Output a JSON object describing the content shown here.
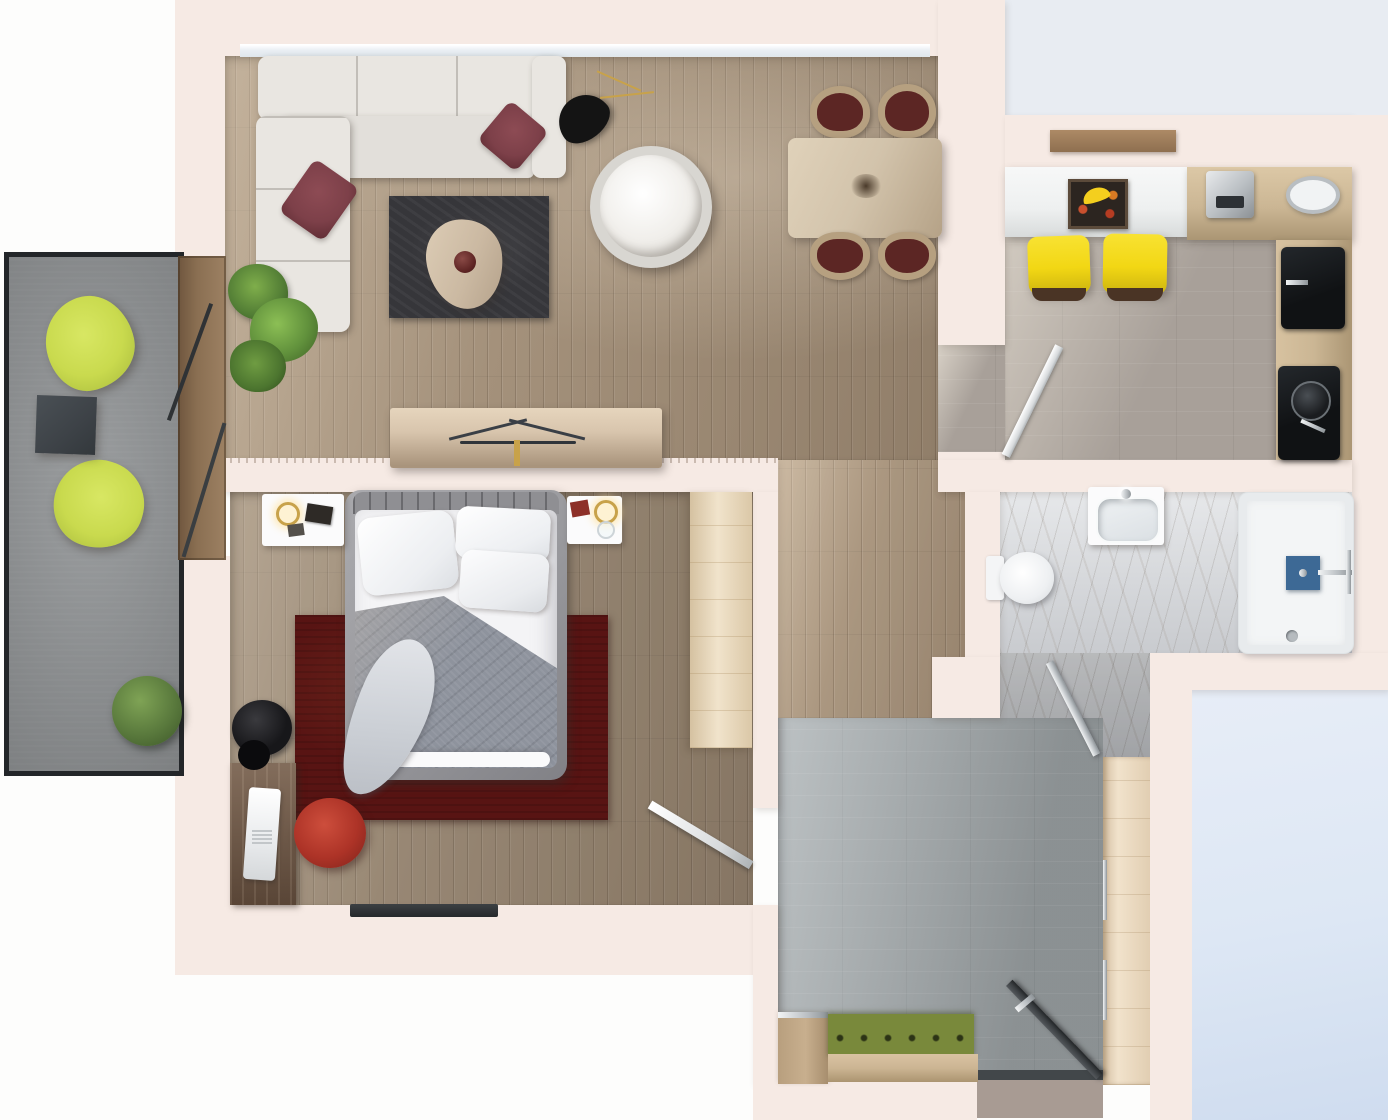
{
  "meta": {
    "title": "Top-down 3D render of a one-bedroom apartment floor plan",
    "type": "architectural-3d-floor-plan",
    "view": "top-down",
    "visible_text": "none"
  },
  "colors": {
    "pageBg": "#fdfdfc",
    "sky": "#e8ecf2",
    "outsideBlue": "#dde7f4",
    "wall": "#f6eae4",
    "woodFloor": "#9f8c76",
    "kitchenTile": "#a8a099",
    "hallTile": "#9aa0a2",
    "marble": "#d2d5d9",
    "balconyFloor": "#8d9092",
    "balconyBorder": "#232629",
    "sofa": "#e9e6e1",
    "pillowRed": "#7d4049",
    "rugLiving": "#36363a",
    "coffeeTableWood": "#cbb9a2",
    "poufWhite": "#f0eeea",
    "lampBlack": "#141414",
    "plantGreen": "#527d35",
    "sideboardWood": "#d8c5ad",
    "diningTableWood": "#d2c3ab",
    "chairSeat": "#5c2624",
    "barCounter": "#eef0f0",
    "counterWood": "#cbb694",
    "stoolYellow": "#f2d714",
    "cooktopBlack": "#101214",
    "applianceSilver": "#b9bec2",
    "bedFrame": "#9a9a9e",
    "duvetGray": "#8e939d",
    "linenWhite": "#f4f4f6",
    "rugBedroom": "#581413",
    "wardrobeWood": "#ecdaba",
    "deskWood": "#6d5645",
    "chairRed": "#ad3327",
    "showerWhite": "#f3f5f6",
    "showerBlue": "#3d6995",
    "benchGreen": "#79893b",
    "benchWood": "#ccb593",
    "closetWood": "#eedcc0",
    "doorDark": "#3c4043",
    "matTaupe": "#a89b93",
    "slidingFrame": "#8a6f52",
    "limeChair": "#c9da4e"
  },
  "scene": {
    "rooms": [
      {
        "id": "living-dining",
        "label": "Living and dining room",
        "floor": "oak plank",
        "furniture": [
          "white corner sofa",
          "two burgundy accent pillows",
          "charcoal rug",
          "triangular wood coffee table with vase",
          "round white pouf",
          "black cone floor lamp",
          "potted green plant",
          "wood sideboard with branch decor",
          "wood dining table",
          "four wood-frame chairs with burgundy seats"
        ]
      },
      {
        "id": "kitchen",
        "label": "Kitchen",
        "floor": "warm grey tile",
        "furniture": [
          "white breakfast bar",
          "fruit wall art with bananas",
          "two yellow bar stools",
          "coffee machine",
          "oval ceiling lamp",
          "wood worktop",
          "black cooktop",
          "black sink with kettle",
          "white swing door"
        ]
      },
      {
        "id": "bedroom",
        "label": "Bedroom",
        "floor": "oak plank",
        "furniture": [
          "double bed with grey duvet and white pillows",
          "two white nightstands with lamps",
          "burgundy rug",
          "built-in wardrobe",
          "dark wood desk",
          "white laptop",
          "red desk chair",
          "black floor lamp",
          "wall tv",
          "white swing door"
        ]
      },
      {
        "id": "bathroom",
        "label": "Bathroom",
        "floor": "marble",
        "furniture": [
          "toilet",
          "vanity washbasin",
          "walk-in shower with blue fixture",
          "glass swing door"
        ]
      },
      {
        "id": "hallway",
        "label": "Entrance hall",
        "floor": "grey tile",
        "furniture": [
          "green tufted bench",
          "wood shoe cabinet",
          "built-in closet",
          "dark entry door"
        ]
      },
      {
        "id": "balcony",
        "label": "Balcony",
        "floor": "concrete",
        "furniture": [
          "two lime green armchairs",
          "dark grey side table",
          "boxwood shrub",
          "sliding glass door"
        ]
      }
    ],
    "exterior_zones": [
      "white backdrop left",
      "pale blue shadow band top right",
      "pale blue terrace bottom right"
    ]
  }
}
